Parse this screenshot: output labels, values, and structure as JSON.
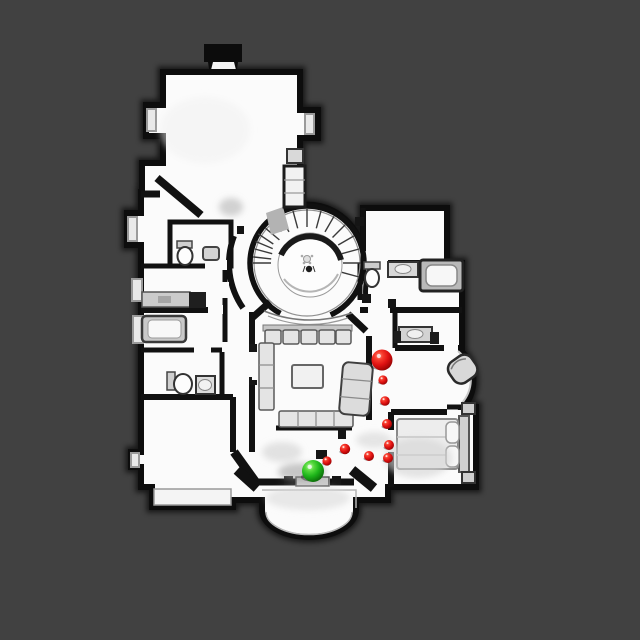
{
  "scene": {
    "name": "top-down house floorplan scan with navigation markers",
    "background_color": "#414141",
    "floor_color": "#fbfbfb",
    "wall_color": "#0d0d0d"
  },
  "markers": {
    "start_marker": {
      "label": "start-position-marker",
      "color": "#1db41a",
      "x": 313,
      "y": 471,
      "r": 11
    },
    "waypoint_color": "#e01212",
    "waypoints": [
      {
        "x": 327,
        "y": 461,
        "r": 4.6
      },
      {
        "x": 345,
        "y": 449,
        "r": 5.2
      },
      {
        "x": 369,
        "y": 456,
        "r": 5.0
      },
      {
        "x": 388,
        "y": 458,
        "r": 5.0
      },
      {
        "x": 389,
        "y": 445,
        "r": 5.0
      },
      {
        "x": 387,
        "y": 424,
        "r": 5.0
      },
      {
        "x": 385,
        "y": 401,
        "r": 4.8
      },
      {
        "x": 383,
        "y": 380,
        "r": 4.6
      },
      {
        "x": 382,
        "y": 360,
        "r": 10.5
      }
    ]
  }
}
